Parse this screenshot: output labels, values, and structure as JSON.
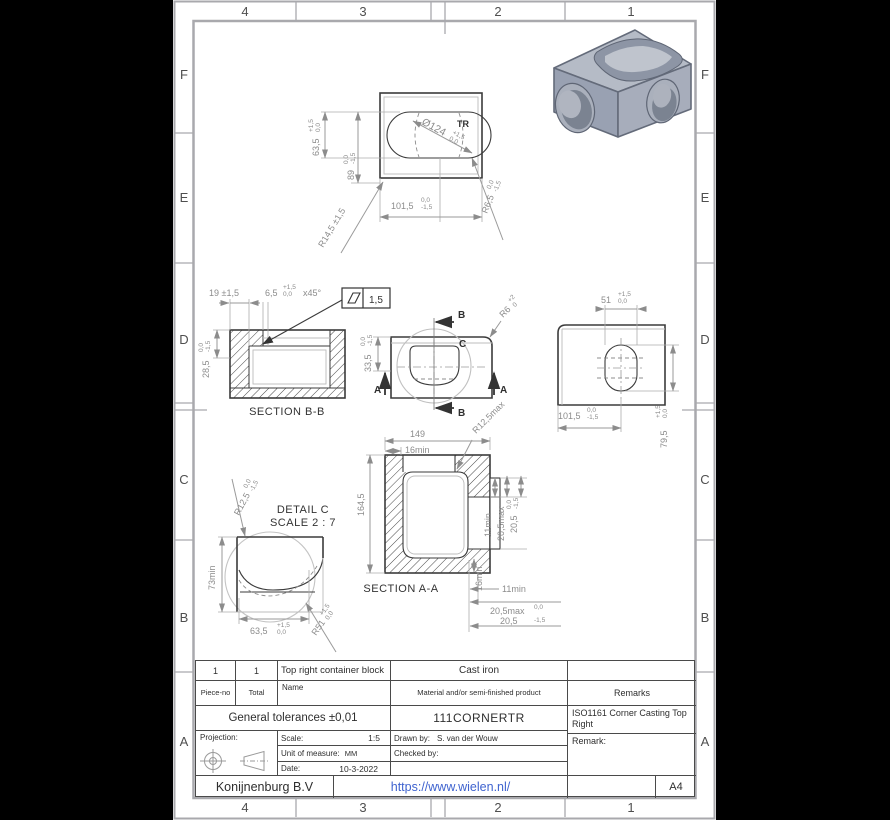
{
  "border": {
    "cols": [
      "4",
      "3",
      "2",
      "1"
    ],
    "rows": [
      "F",
      "E",
      "D",
      "C",
      "B",
      "A"
    ]
  },
  "top_view": {
    "dia": "Ø124",
    "dia_up": "+1,5",
    "dia_dn": "0,0",
    "dia_suffix": "TR",
    "h635": "63,5",
    "h635_up": "+1,5",
    "h635_dn": "0,0",
    "h89": "89",
    "h89_up": "0,0",
    "h89_dn": "-1,5",
    "w1015": "101,5",
    "w1015_up": "0,0",
    "w1015_dn": "-1,5",
    "r145": "R14,5 ±1,5",
    "r65": "R6,5",
    "r65_up": "0,0",
    "r65_dn": "-1,5"
  },
  "section_bb": {
    "label": "SECTION B-B",
    "d19": "19 ±1,5",
    "d65": "6,5",
    "d65_up": "+1,5",
    "d65_dn": "0,0",
    "d65_suffix": "x45°",
    "fcf_value": "1,5",
    "d285": "28,5",
    "d285_up": "0,0",
    "d285_dn": "-1,5"
  },
  "front_view": {
    "d335": "33,5",
    "d335_up": "0,0",
    "d335_dn": "-1,5",
    "r6": "R6",
    "r6_up": "+2",
    "r6_dn": "0",
    "mark_a": "A",
    "mark_b": "B",
    "mark_c": "C"
  },
  "side_view": {
    "d51": "51",
    "d51_up": "+1,5",
    "d51_dn": "0,0",
    "d1015": "101,5",
    "d1015_up": "0,0",
    "d1015_dn": "-1,5",
    "d795": "79,5",
    "d795_up": "+1,5",
    "d795_dn": "0,0"
  },
  "section_aa": {
    "label": "SECTION A-A",
    "d149": "149",
    "d16min_top": "16min",
    "r125max": "R12,5max",
    "d1645": "164,5",
    "d11min_side": "11min",
    "d205max_side": "20,5max",
    "d205_side": "20,5",
    "d205_side_up": "0,0",
    "d205_side_dn": "-1,5",
    "d16min_bottom": "16min",
    "d11min_bottom": "11min",
    "d205max_bottom": "20,5max",
    "d205_bottom": "20,5",
    "d205_bottom_up": "0,0",
    "d205_bottom_dn": "-1,5"
  },
  "detail_c": {
    "title": "DETAIL C",
    "scale": "SCALE 2 : 7",
    "r125": "R12,5",
    "r125_up": "0,0",
    "r125_dn": "-1,5",
    "d73min": "73min",
    "d635": "63,5",
    "d635_up": "+1,5",
    "d635_dn": "0,0",
    "r51": "R51",
    "r51_up": "+1,5",
    "r51_dn": "0,0"
  },
  "title_block": {
    "piece_value": "1",
    "total_value": "1",
    "piece_label": "Piece-no",
    "total_label": "Total",
    "name_label": "Name",
    "name_value": "Top right container block",
    "material_label": "Material and/or semi-finished product",
    "material_value": "Cast iron",
    "remarks_label": "Remarks",
    "tolerances": "General tolerances ±0,01",
    "part_number": "111CORNERTR",
    "remarks_value": "ISO1161 Corner Casting Top Right",
    "remark_label": "Remark:",
    "projection_label": "Projection:",
    "scale_label": "Scale:",
    "scale_value": "1:5",
    "unit_label": "Unit of measure:",
    "unit_value": "MM",
    "date_label": "Date:",
    "date_value": "10-3-2022",
    "drawn_label": "Drawn by:",
    "drawn_value": "S. van der Wouw",
    "checked_label": "Checked by:",
    "company": "Konijnenburg B.V",
    "website": "https://www.wielen.nl/",
    "paper_size": "A4"
  },
  "colors": {
    "link": "#3f63cf",
    "line_dark": "#3b3b3b",
    "dim": "#8c8c8c"
  }
}
